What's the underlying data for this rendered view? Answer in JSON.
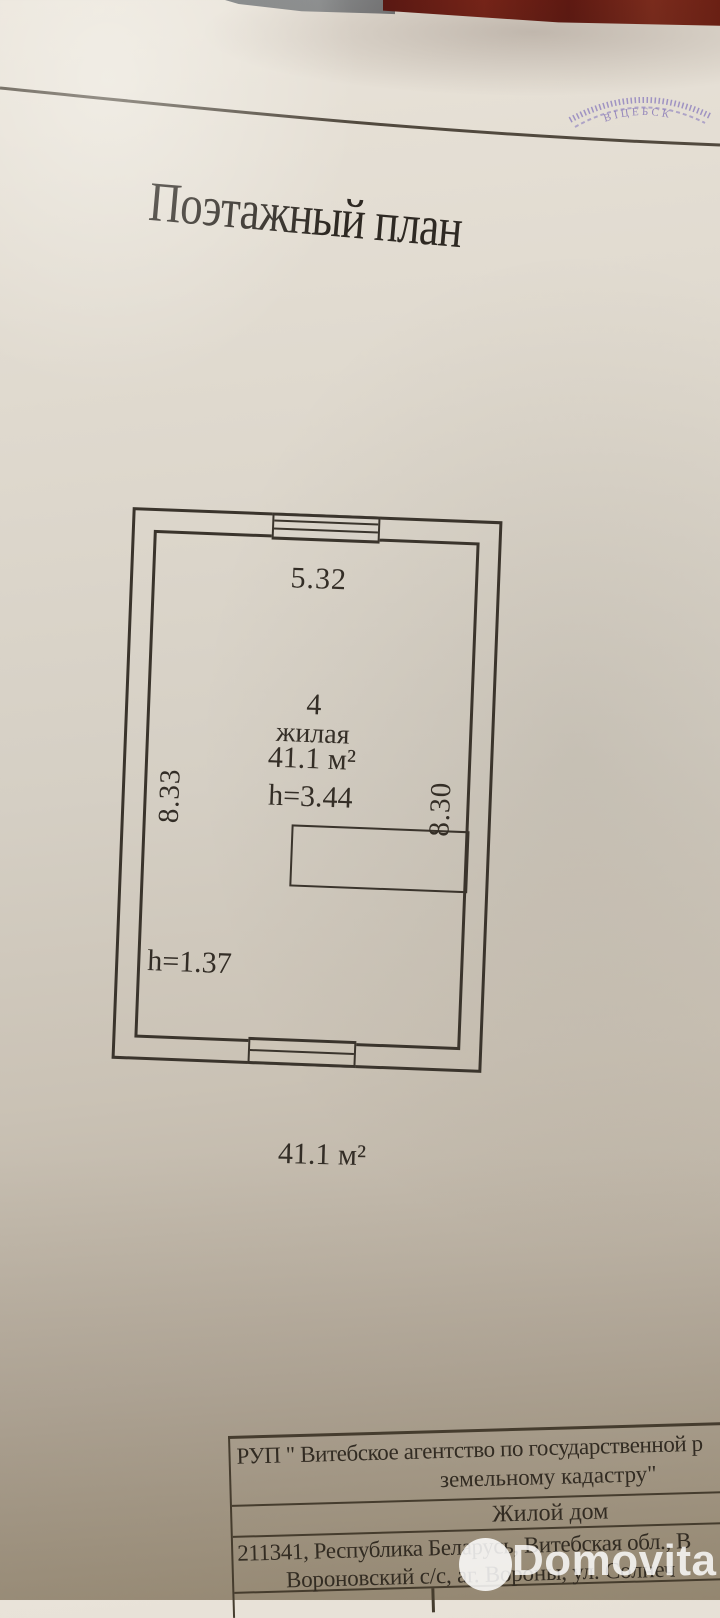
{
  "doc": {
    "title": "Поэтажный план",
    "stamp_text": "ВІЦЕБСК",
    "plan": {
      "dim_top": "5.32",
      "dim_left": "8.33",
      "dim_right": "8.30",
      "room_number": "4",
      "room_type": "жилая",
      "room_area": "41.1 м²",
      "ceiling_height": "h=3.44",
      "ceiling_height_2": "h=1.37",
      "total_area": "41.1 м²"
    },
    "footer": {
      "agency_line1": "РУП \" Витебское агентство по государственной р",
      "agency_line2": "земельному кадастру\"",
      "object_type": "Жилой дом",
      "address_line1": "211341, Республика Беларусь, Витебская обл., В",
      "address_line2": "Вороновский с/с, аг. Вороны, ул. Солнеч"
    }
  },
  "watermark": {
    "brand": "Domovita"
  },
  "colors": {
    "paper": "#d9d3c8",
    "ink": "#3a342c",
    "fabric_red": "#6d1c14",
    "fabric_gray": "#7e8183",
    "stamp_purple": "#8172bb",
    "watermark_white": "#ffffff"
  }
}
